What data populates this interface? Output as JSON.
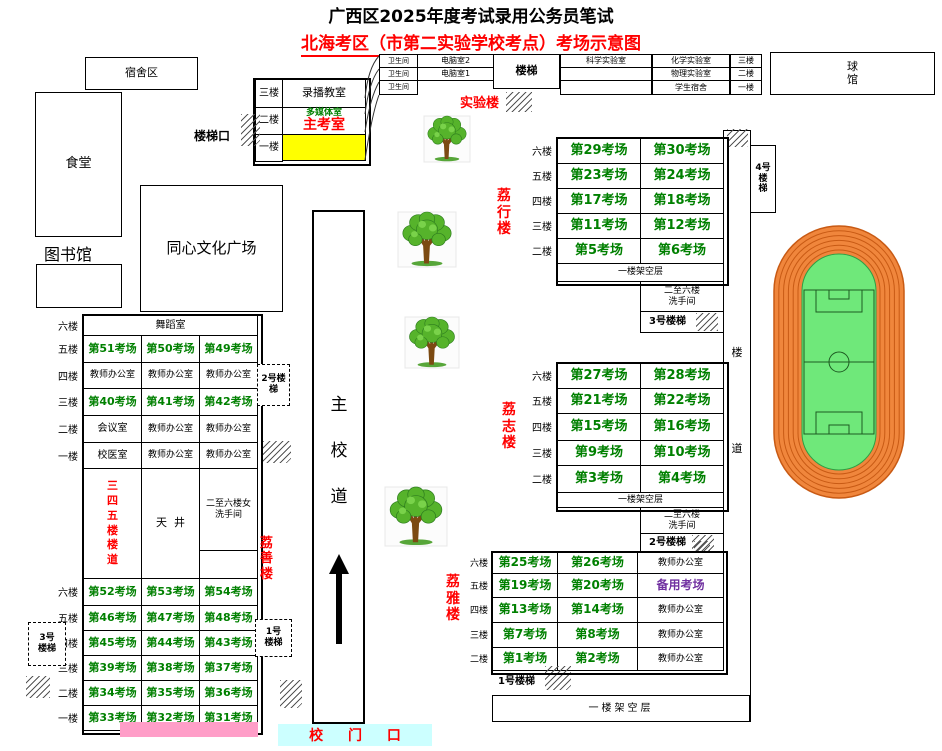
{
  "title": "广西区2025年度考试录用公务员笔试",
  "subtitle": {
    "underlined": "北海考区（市第二实验学校考点）",
    "rest": "考场示意图"
  },
  "colors": {
    "exam_green": "#008000",
    "red": "#FF0000",
    "purple": "#7030A0",
    "yellow": "#FFFF00",
    "pink": "#FF9EC8",
    "cyan": "#CCFFFF",
    "track_orange": "#F0863C",
    "track_line": "#C85A14",
    "field_green": "#6FE87A",
    "tree_green": "#56B32B",
    "trunk_brown": "#7C4A12"
  },
  "places": {
    "dorm": "宿舍区",
    "canteen": "食堂",
    "library": "图书馆",
    "plaza": "同心文化广场",
    "ball_hall": "球馆",
    "stair_exit": "楼梯口",
    "road": "主校道",
    "gate": "校 门 口"
  },
  "main_building": {
    "floors": [
      "三楼",
      "二楼",
      "一楼"
    ],
    "recording_room": "录播教室",
    "multimedia_room": "多媒体室",
    "chief_exam_room": "主考室"
  },
  "lab_building": {
    "label": "实验楼",
    "stair": "楼梯",
    "restroom": "卫生间",
    "left_rooms": [
      "电脑室2",
      "电脑室1"
    ],
    "rows": [
      [
        "科学实验室",
        "化学实验室",
        "三楼"
      ],
      [
        "",
        "物理实验室",
        "二楼"
      ],
      [
        "",
        "学生宿舍",
        "一楼"
      ]
    ]
  },
  "corridor": {
    "label": "楼道",
    "stair": "4号楼梯"
  },
  "stairs": {
    "no1": "1号楼梯",
    "no2": "2号楼梯",
    "no3": "3号楼梯"
  },
  "lixing": {
    "name": "荔行楼",
    "floors": [
      "六楼",
      "五楼",
      "四楼",
      "三楼",
      "二楼"
    ],
    "rows": [
      [
        "第29考场",
        "第30考场"
      ],
      [
        "第23考场",
        "第24考场"
      ],
      [
        "第17考场",
        "第18考场"
      ],
      [
        "第11考场",
        "第12考场"
      ],
      [
        "第5考场",
        "第6考场"
      ]
    ],
    "ground": "一楼架空层",
    "washroom": "二至六楼\n洗手间",
    "stair": "3号楼梯"
  },
  "lizhi": {
    "name": "荔志楼",
    "floors": [
      "六楼",
      "五楼",
      "四楼",
      "三楼",
      "二楼"
    ],
    "rows": [
      [
        "第27考场",
        "第28考场"
      ],
      [
        "第21考场",
        "第22考场"
      ],
      [
        "第15考场",
        "第16考场"
      ],
      [
        "第9考场",
        "第10考场"
      ],
      [
        "第3考场",
        "第4考场"
      ]
    ],
    "ground": "一楼架空层",
    "washroom": "二至六楼\n洗手间",
    "stair": "2号楼梯"
  },
  "liya": {
    "name": "荔雅楼",
    "floors": [
      "六楼",
      "五楼",
      "四楼",
      "三楼",
      "二楼"
    ],
    "rows": [
      [
        "第25考场",
        "第26考场",
        "教师办公室"
      ],
      [
        "第19考场",
        "第20考场",
        "备用考场"
      ],
      [
        "第13考场",
        "第14考场",
        "教师办公室"
      ],
      [
        "第7考场",
        "第8考场",
        "教师办公室"
      ],
      [
        "第1考场",
        "第2考场",
        "教师办公室"
      ]
    ],
    "stair": "1号楼梯",
    "ground": "一楼架空层"
  },
  "lishan": {
    "name": "荔善楼",
    "floors_top": [
      "六楼",
      "五楼",
      "四楼",
      "三楼",
      "二楼",
      "一楼"
    ],
    "top_rows": [
      [
        {
          "t": "舞蹈室",
          "s": 3
        }
      ],
      [
        "第51考场",
        "第50考场",
        "第49考场"
      ],
      [
        "教师办公室",
        "教师办公室",
        "教师办公室"
      ],
      [
        "第40考场",
        "第41考场",
        "第42考场"
      ],
      [
        "会议室",
        "教师办公室",
        "教师办公室"
      ],
      [
        "校医室",
        "教师办公室",
        "教师办公室"
      ]
    ],
    "mid": {
      "left": "三四五楼楼道",
      "center": "天  井",
      "right": "二至六楼女\n洗手间"
    },
    "floors_bottom": [
      "六楼",
      "五楼",
      "四楼",
      "三楼",
      "二楼",
      "一楼"
    ],
    "bottom_rows": [
      [
        "第52考场",
        "第53考场",
        "第54考场"
      ],
      [
        "第46考场",
        "第47考场",
        "第48考场"
      ],
      [
        "第45考场",
        "第44考场",
        "第43考场"
      ],
      [
        "第39考场",
        "第38考场",
        "第37考场"
      ],
      [
        "第34考场",
        "第35考场",
        "第36考场"
      ],
      [
        "第33考场",
        "第32考场",
        "第31考场"
      ]
    ]
  }
}
